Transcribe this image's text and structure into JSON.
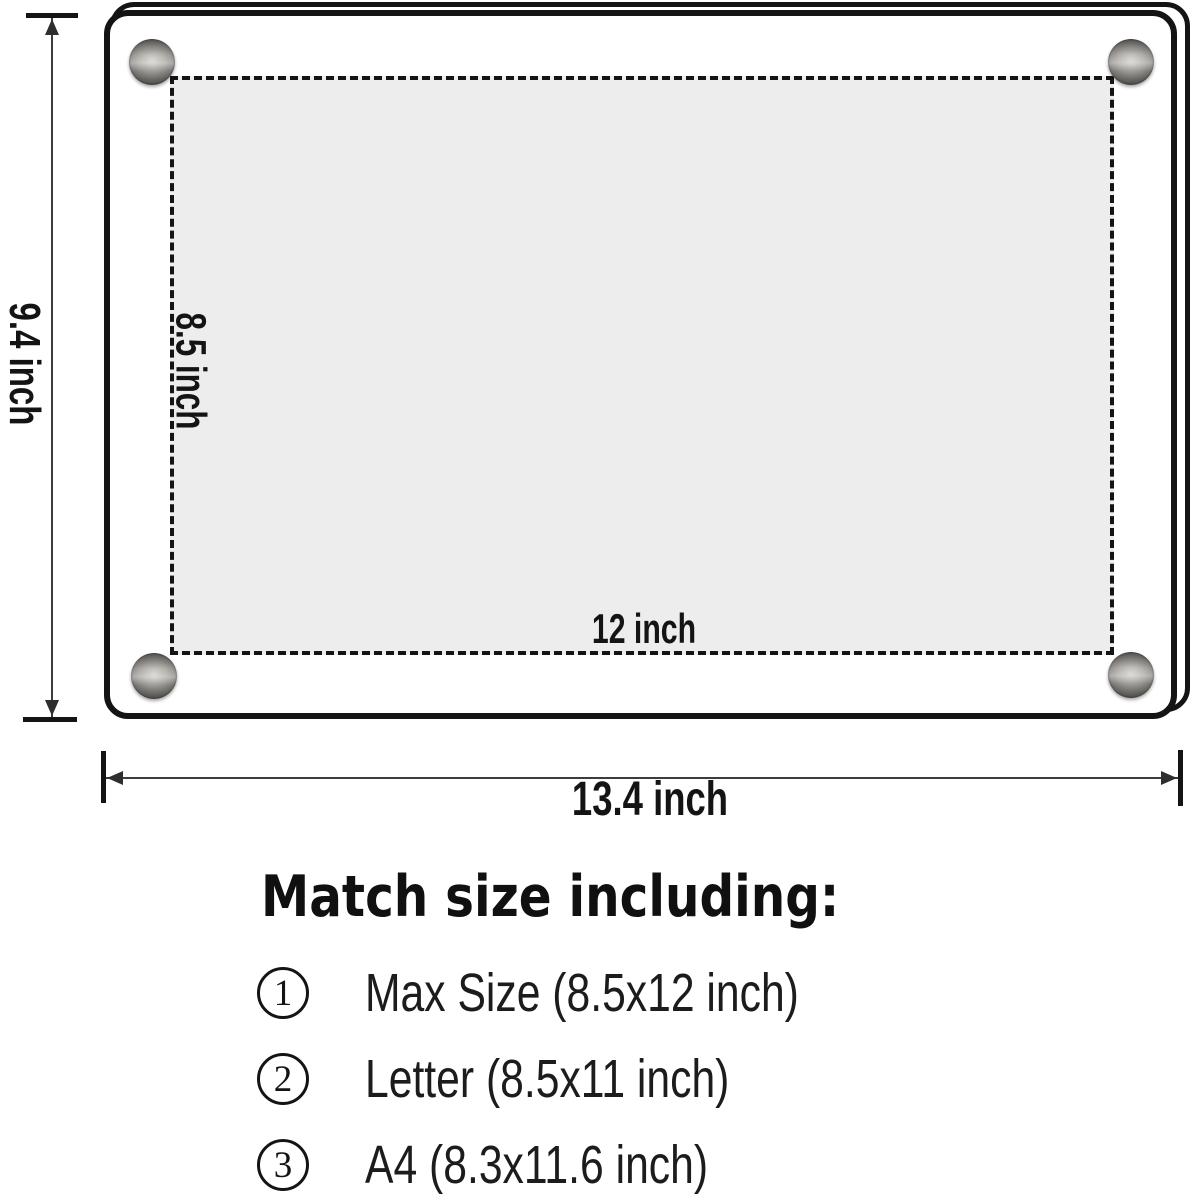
{
  "frame": {
    "height_label": "9.4 inch",
    "width_label": "13.4 inch"
  },
  "insert": {
    "height_label": "8.5 inch",
    "width_label": "12 inch"
  },
  "match": {
    "heading": "Match size including:",
    "items": [
      {
        "number": "1",
        "label": "Max Size (8.5x12 inch)"
      },
      {
        "number": "2",
        "label": "Letter (8.5x11 inch)"
      },
      {
        "number": "3",
        "label": "A4 (8.3x11.6 inch)"
      }
    ]
  },
  "colors": {
    "line": "#141414",
    "insert_fill": "#ededed",
    "background": "#ffffff"
  }
}
